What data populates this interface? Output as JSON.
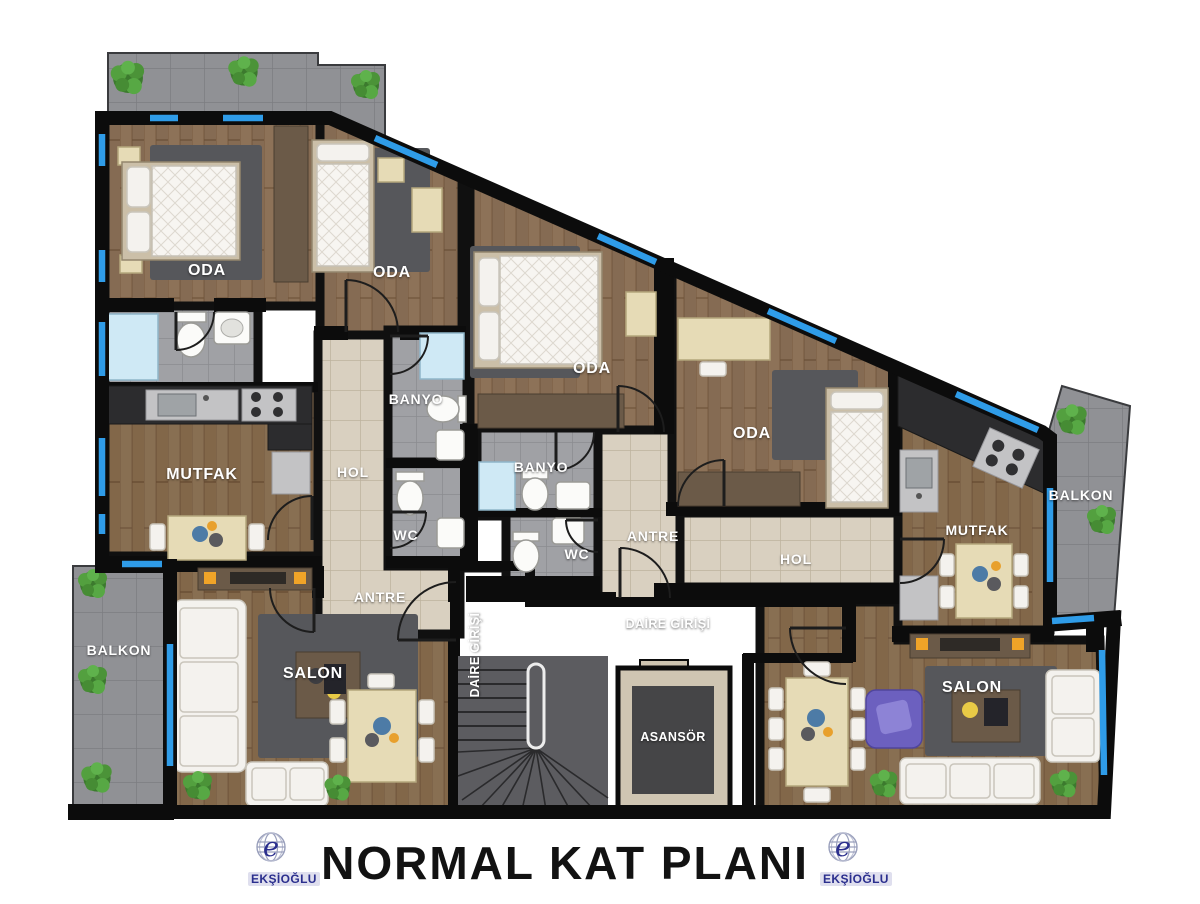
{
  "title": "NORMAL KAT PLANI",
  "brand": {
    "name": "EKŞİOĞLU",
    "monogram": "e"
  },
  "labels": {
    "oda": "ODA",
    "banyo": "BANYO",
    "wc": "WC",
    "mutfak": "MUTFAK",
    "hol": "HOL",
    "antre": "ANTRE",
    "salon": "SALON",
    "balkon": "BALKON",
    "asansor": "ASANSÖR",
    "daire_girisi": "DAİRE GİRİŞİ"
  },
  "colors": {
    "window_blue": "#2f9ce8",
    "wall": "#0c0c0c",
    "rug_gray": "#56575b",
    "accent_purple": "#6c60bf",
    "logo_navy": "#2b2f8e",
    "title_black": "#121212"
  }
}
